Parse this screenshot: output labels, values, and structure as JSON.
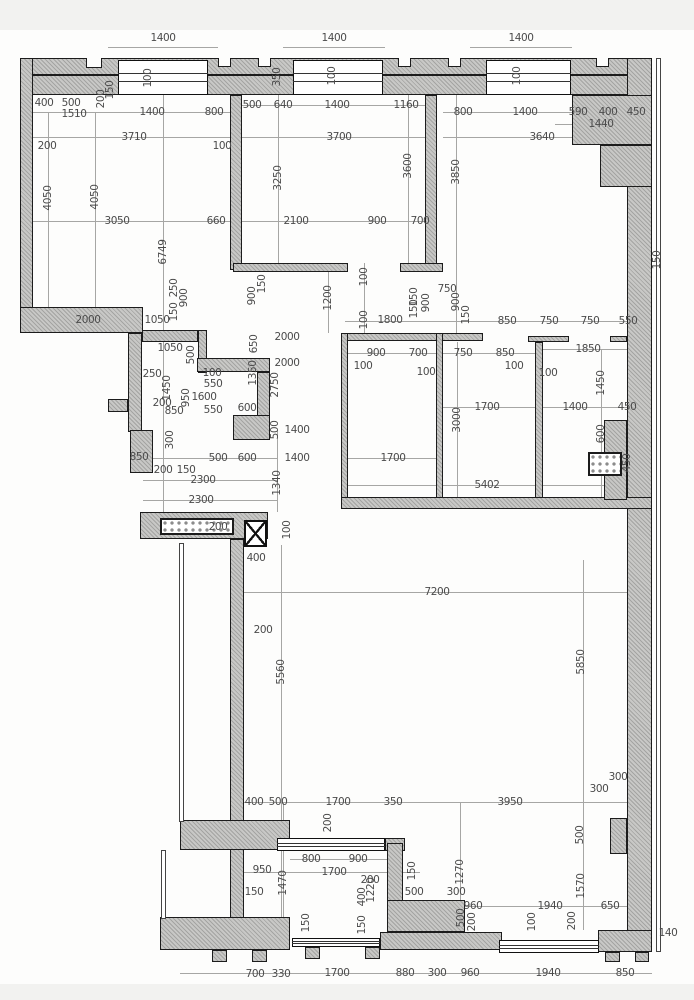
{
  "plan": {
    "size": {
      "w": 694,
      "h": 1000
    },
    "strips": [
      [
        0,
        0,
        694,
        30
      ],
      [
        0,
        984,
        694,
        16
      ]
    ],
    "walls": [
      [
        20,
        58,
        632,
        17
      ],
      [
        20,
        75,
        632,
        20
      ],
      [
        20,
        58,
        13,
        275
      ],
      [
        20,
        307,
        123,
        26
      ],
      [
        627,
        58,
        25,
        894
      ],
      [
        572,
        95,
        80,
        50
      ],
      [
        600,
        145,
        52,
        42
      ],
      [
        230,
        95,
        12,
        175
      ],
      [
        425,
        95,
        12,
        175
      ],
      [
        233,
        263,
        115,
        9
      ],
      [
        400,
        263,
        43,
        9
      ],
      [
        128,
        333,
        14,
        99
      ],
      [
        142,
        330,
        56,
        12
      ],
      [
        198,
        330,
        9,
        43
      ],
      [
        197,
        358,
        73,
        14
      ],
      [
        257,
        372,
        13,
        45
      ],
      [
        233,
        415,
        37,
        25
      ],
      [
        108,
        399,
        20,
        13
      ],
      [
        130,
        430,
        23,
        43
      ],
      [
        341,
        333,
        142,
        8
      ],
      [
        528,
        336,
        41,
        6
      ],
      [
        610,
        336,
        17,
        6
      ],
      [
        341,
        333,
        7,
        170
      ],
      [
        436,
        333,
        7,
        170
      ],
      [
        535,
        342,
        8,
        161
      ],
      [
        341,
        497,
        311,
        12
      ],
      [
        604,
        420,
        23,
        80
      ],
      [
        140,
        512,
        128,
        27
      ],
      [
        230,
        539,
        14,
        395
      ],
      [
        180,
        820,
        110,
        30
      ],
      [
        160,
        917,
        130,
        33
      ],
      [
        380,
        932,
        122,
        18
      ],
      [
        598,
        930,
        54,
        22
      ],
      [
        610,
        818,
        17,
        36
      ],
      [
        385,
        838,
        20,
        13
      ],
      [
        387,
        843,
        16,
        64
      ],
      [
        387,
        900,
        78,
        32
      ],
      [
        212,
        950,
        15,
        12
      ],
      [
        252,
        950,
        15,
        12
      ],
      [
        305,
        947,
        15,
        12
      ],
      [
        365,
        947,
        15,
        12
      ],
      [
        605,
        952,
        15,
        10
      ],
      [
        635,
        952,
        14,
        10
      ]
    ],
    "notches": [
      [
        86,
        58,
        16,
        10
      ],
      [
        218,
        58,
        13,
        9
      ],
      [
        258,
        58,
        13,
        9
      ],
      [
        398,
        58,
        13,
        9
      ],
      [
        448,
        58,
        13,
        9
      ],
      [
        596,
        58,
        13,
        9
      ]
    ],
    "thin": [
      [
        656,
        58,
        5,
        894
      ],
      [
        179,
        543,
        5,
        279
      ],
      [
        161,
        850,
        5,
        69
      ]
    ],
    "windows": [
      [
        118,
        60,
        90,
        35
      ],
      [
        293,
        60,
        90,
        35
      ],
      [
        486,
        60,
        85,
        35
      ],
      [
        499,
        940,
        100,
        13
      ],
      [
        277,
        838,
        108,
        13
      ],
      [
        292,
        938,
        88,
        9
      ]
    ],
    "vents": [
      [
        160,
        518,
        74,
        17
      ],
      [
        588,
        452,
        34,
        24
      ]
    ],
    "columns": [
      [
        244,
        520,
        23,
        27
      ]
    ],
    "lines": [
      [
        108,
        47,
        218,
        47
      ],
      [
        283,
        47,
        385,
        47
      ],
      [
        470,
        47,
        572,
        47
      ],
      [
        33,
        112,
        230,
        112
      ],
      [
        242,
        105,
        425,
        105
      ],
      [
        443,
        112,
        648,
        112
      ],
      [
        555,
        124,
        648,
        124
      ],
      [
        33,
        137,
        230,
        137
      ],
      [
        242,
        137,
        437,
        137
      ],
      [
        443,
        137,
        627,
        137
      ],
      [
        33,
        221,
        242,
        221
      ],
      [
        242,
        221,
        437,
        221
      ],
      [
        20,
        321,
        143,
        321
      ],
      [
        345,
        321,
        648,
        321
      ],
      [
        348,
        353,
        535,
        353
      ],
      [
        543,
        349,
        627,
        349
      ],
      [
        443,
        407,
        535,
        407
      ],
      [
        543,
        407,
        648,
        407
      ],
      [
        348,
        458,
        443,
        458
      ],
      [
        143,
        458,
        277,
        458
      ],
      [
        348,
        485,
        627,
        485
      ],
      [
        143,
        480,
        277,
        480
      ],
      [
        143,
        500,
        277,
        500
      ],
      [
        243,
        592,
        648,
        592
      ],
      [
        243,
        802,
        627,
        802
      ],
      [
        290,
        859,
        387,
        859
      ],
      [
        243,
        872,
        420,
        872
      ],
      [
        443,
        906,
        648,
        906
      ],
      [
        180,
        973,
        652,
        973
      ],
      [
        48,
        112,
        48,
        307
      ],
      [
        95,
        112,
        95,
        307
      ],
      [
        163,
        95,
        163,
        512
      ],
      [
        278,
        95,
        278,
        263
      ],
      [
        408,
        95,
        408,
        263
      ],
      [
        456,
        95,
        456,
        335
      ],
      [
        281,
        545,
        281,
        932
      ],
      [
        583,
        560,
        583,
        930
      ],
      [
        601,
        349,
        601,
        497
      ],
      [
        457,
        342,
        457,
        497
      ],
      [
        328,
        270,
        328,
        333
      ],
      [
        277,
        430,
        277,
        512
      ],
      [
        460,
        802,
        460,
        932
      ],
      [
        283,
        802,
        283,
        932
      ],
      [
        364,
        263,
        364,
        333
      ]
    ],
    "labels": [
      {
        "t": "1400",
        "x": 163,
        "y": 38
      },
      {
        "t": "1400",
        "x": 334,
        "y": 38
      },
      {
        "t": "1400",
        "x": 521,
        "y": 38
      },
      {
        "t": "200",
        "x": 101,
        "y": 99,
        "r": 1
      },
      {
        "t": "150",
        "x": 110,
        "y": 90,
        "r": 1
      },
      {
        "t": "100",
        "x": 148,
        "y": 78,
        "r": 1
      },
      {
        "t": "350",
        "x": 277,
        "y": 77,
        "r": 1
      },
      {
        "t": "100",
        "x": 332,
        "y": 76,
        "r": 1
      },
      {
        "t": "100",
        "x": 517,
        "y": 76,
        "r": 1
      },
      {
        "t": "400",
        "x": 44,
        "y": 103
      },
      {
        "t": "500",
        "x": 71,
        "y": 103
      },
      {
        "t": "1510",
        "x": 74,
        "y": 114
      },
      {
        "t": "1400",
        "x": 152,
        "y": 112
      },
      {
        "t": "800",
        "x": 214,
        "y": 112
      },
      {
        "t": "500",
        "x": 252,
        "y": 105
      },
      {
        "t": "640",
        "x": 283,
        "y": 105
      },
      {
        "t": "1400",
        "x": 337,
        "y": 105
      },
      {
        "t": "1160",
        "x": 406,
        "y": 105
      },
      {
        "t": "800",
        "x": 463,
        "y": 112
      },
      {
        "t": "1400",
        "x": 525,
        "y": 112
      },
      {
        "t": "590",
        "x": 578,
        "y": 112
      },
      {
        "t": "400",
        "x": 608,
        "y": 112
      },
      {
        "t": "450",
        "x": 636,
        "y": 112
      },
      {
        "t": "1440",
        "x": 601,
        "y": 124
      },
      {
        "t": "3710",
        "x": 134,
        "y": 137
      },
      {
        "t": "200",
        "x": 47,
        "y": 146
      },
      {
        "t": "100",
        "x": 222,
        "y": 146
      },
      {
        "t": "3700",
        "x": 339,
        "y": 137
      },
      {
        "t": "3640",
        "x": 542,
        "y": 137
      },
      {
        "t": "4050",
        "x": 48,
        "y": 198,
        "r": 1
      },
      {
        "t": "4050",
        "x": 95,
        "y": 197,
        "r": 1
      },
      {
        "t": "3250",
        "x": 278,
        "y": 178,
        "r": 1
      },
      {
        "t": "3600",
        "x": 408,
        "y": 166,
        "r": 1
      },
      {
        "t": "3850",
        "x": 456,
        "y": 172,
        "r": 1
      },
      {
        "t": "150",
        "x": 657,
        "y": 260,
        "r": 1
      },
      {
        "t": "3050",
        "x": 117,
        "y": 221
      },
      {
        "t": "660",
        "x": 216,
        "y": 221
      },
      {
        "t": "2100",
        "x": 296,
        "y": 221
      },
      {
        "t": "900",
        "x": 377,
        "y": 221
      },
      {
        "t": "700",
        "x": 420,
        "y": 221
      },
      {
        "t": "6749",
        "x": 163,
        "y": 252,
        "r": 1
      },
      {
        "t": "250",
        "x": 174,
        "y": 288,
        "r": 1
      },
      {
        "t": "900",
        "x": 184,
        "y": 298,
        "r": 1
      },
      {
        "t": "150",
        "x": 174,
        "y": 312,
        "r": 1
      },
      {
        "t": "2000",
        "x": 88,
        "y": 320
      },
      {
        "t": "1050",
        "x": 157,
        "y": 320
      },
      {
        "t": "150",
        "x": 262,
        "y": 284,
        "r": 1
      },
      {
        "t": "900",
        "x": 252,
        "y": 296,
        "r": 1
      },
      {
        "t": "1200",
        "x": 328,
        "y": 298,
        "r": 1
      },
      {
        "t": "100",
        "x": 364,
        "y": 277,
        "r": 1
      },
      {
        "t": "100",
        "x": 364,
        "y": 320,
        "r": 1
      },
      {
        "t": "1800",
        "x": 390,
        "y": 320
      },
      {
        "t": "150",
        "x": 414,
        "y": 297,
        "r": 1
      },
      {
        "t": "150",
        "x": 414,
        "y": 309,
        "r": 1
      },
      {
        "t": "900",
        "x": 426,
        "y": 303,
        "r": 1
      },
      {
        "t": "750",
        "x": 447,
        "y": 289
      },
      {
        "t": "900",
        "x": 456,
        "y": 302,
        "r": 1
      },
      {
        "t": "150",
        "x": 466,
        "y": 315,
        "r": 1
      },
      {
        "t": "850",
        "x": 507,
        "y": 321
      },
      {
        "t": "750",
        "x": 549,
        "y": 321
      },
      {
        "t": "750",
        "x": 590,
        "y": 321
      },
      {
        "t": "550",
        "x": 628,
        "y": 321
      },
      {
        "t": "2000",
        "x": 287,
        "y": 337
      },
      {
        "t": "2000",
        "x": 287,
        "y": 363
      },
      {
        "t": "650",
        "x": 254,
        "y": 344,
        "r": 1
      },
      {
        "t": "1050",
        "x": 170,
        "y": 348
      },
      {
        "t": "500",
        "x": 191,
        "y": 355,
        "r": 1
      },
      {
        "t": "1350",
        "x": 253,
        "y": 373,
        "r": 1
      },
      {
        "t": "2750",
        "x": 275,
        "y": 385,
        "r": 1
      },
      {
        "t": "250",
        "x": 152,
        "y": 374
      },
      {
        "t": "1450",
        "x": 167,
        "y": 388,
        "r": 1
      },
      {
        "t": "100",
        "x": 212,
        "y": 373
      },
      {
        "t": "550",
        "x": 213,
        "y": 384
      },
      {
        "t": "950",
        "x": 186,
        "y": 398,
        "r": 1
      },
      {
        "t": "1600",
        "x": 204,
        "y": 397
      },
      {
        "t": "200",
        "x": 162,
        "y": 403
      },
      {
        "t": "850",
        "x": 174,
        "y": 411
      },
      {
        "t": "550",
        "x": 213,
        "y": 410
      },
      {
        "t": "600",
        "x": 247,
        "y": 408
      },
      {
        "t": "500",
        "x": 275,
        "y": 430,
        "r": 1
      },
      {
        "t": "1400",
        "x": 297,
        "y": 430
      },
      {
        "t": "1400",
        "x": 297,
        "y": 458
      },
      {
        "t": "300",
        "x": 170,
        "y": 440,
        "r": 1
      },
      {
        "t": "850",
        "x": 139,
        "y": 457
      },
      {
        "t": "500",
        "x": 218,
        "y": 458
      },
      {
        "t": "600",
        "x": 247,
        "y": 458
      },
      {
        "t": "200",
        "x": 163,
        "y": 470
      },
      {
        "t": "150",
        "x": 186,
        "y": 470
      },
      {
        "t": "2300",
        "x": 203,
        "y": 480
      },
      {
        "t": "2300",
        "x": 201,
        "y": 500
      },
      {
        "t": "1340",
        "x": 277,
        "y": 483,
        "r": 1
      },
      {
        "t": "900",
        "x": 376,
        "y": 353
      },
      {
        "t": "700",
        "x": 418,
        "y": 353
      },
      {
        "t": "750",
        "x": 463,
        "y": 353
      },
      {
        "t": "850",
        "x": 505,
        "y": 353
      },
      {
        "t": "100",
        "x": 363,
        "y": 366
      },
      {
        "t": "100",
        "x": 426,
        "y": 372
      },
      {
        "t": "100",
        "x": 514,
        "y": 366
      },
      {
        "t": "1850",
        "x": 588,
        "y": 349
      },
      {
        "t": "100",
        "x": 548,
        "y": 373
      },
      {
        "t": "1450",
        "x": 601,
        "y": 383,
        "r": 1
      },
      {
        "t": "1700",
        "x": 487,
        "y": 407
      },
      {
        "t": "3000",
        "x": 457,
        "y": 420,
        "r": 1
      },
      {
        "t": "1400",
        "x": 575,
        "y": 407
      },
      {
        "t": "450",
        "x": 627,
        "y": 407
      },
      {
        "t": "600",
        "x": 601,
        "y": 434,
        "r": 1
      },
      {
        "t": "450",
        "x": 627,
        "y": 463,
        "r": 1
      },
      {
        "t": "1700",
        "x": 393,
        "y": 458
      },
      {
        "t": "5402",
        "x": 487,
        "y": 485
      },
      {
        "t": "200",
        "x": 218,
        "y": 527
      },
      {
        "t": "100",
        "x": 287,
        "y": 530,
        "r": 1
      },
      {
        "t": "400",
        "x": 256,
        "y": 558
      },
      {
        "t": "7200",
        "x": 437,
        "y": 592
      },
      {
        "t": "200",
        "x": 263,
        "y": 630
      },
      {
        "t": "5560",
        "x": 281,
        "y": 672,
        "r": 1
      },
      {
        "t": "5850",
        "x": 581,
        "y": 662,
        "r": 1
      },
      {
        "t": "300",
        "x": 618,
        "y": 777
      },
      {
        "t": "300",
        "x": 599,
        "y": 789
      },
      {
        "t": "400",
        "x": 254,
        "y": 802
      },
      {
        "t": "500",
        "x": 278,
        "y": 802
      },
      {
        "t": "1700",
        "x": 338,
        "y": 802
      },
      {
        "t": "350",
        "x": 393,
        "y": 802
      },
      {
        "t": "3950",
        "x": 510,
        "y": 802
      },
      {
        "t": "200",
        "x": 328,
        "y": 823,
        "r": 1
      },
      {
        "t": "800",
        "x": 311,
        "y": 859
      },
      {
        "t": "900",
        "x": 358,
        "y": 859
      },
      {
        "t": "1700",
        "x": 334,
        "y": 872
      },
      {
        "t": "200",
        "x": 370,
        "y": 880
      },
      {
        "t": "150",
        "x": 412,
        "y": 871,
        "r": 1
      },
      {
        "t": "950",
        "x": 262,
        "y": 870
      },
      {
        "t": "150",
        "x": 254,
        "y": 892
      },
      {
        "t": "1470",
        "x": 283,
        "y": 883,
        "r": 1
      },
      {
        "t": "500",
        "x": 414,
        "y": 892
      },
      {
        "t": "300",
        "x": 456,
        "y": 892
      },
      {
        "t": "1270",
        "x": 460,
        "y": 872,
        "r": 1
      },
      {
        "t": "500",
        "x": 580,
        "y": 835,
        "r": 1
      },
      {
        "t": "1570",
        "x": 581,
        "y": 886,
        "r": 1
      },
      {
        "t": "960",
        "x": 473,
        "y": 906
      },
      {
        "t": "1940",
        "x": 550,
        "y": 906
      },
      {
        "t": "650",
        "x": 610,
        "y": 906
      },
      {
        "t": "500",
        "x": 461,
        "y": 918,
        "r": 1
      },
      {
        "t": "200",
        "x": 472,
        "y": 922,
        "r": 1
      },
      {
        "t": "100",
        "x": 532,
        "y": 922,
        "r": 1
      },
      {
        "t": "200",
        "x": 572,
        "y": 921,
        "r": 1
      },
      {
        "t": "150",
        "x": 306,
        "y": 923,
        "r": 1
      },
      {
        "t": "150",
        "x": 362,
        "y": 925,
        "r": 1
      },
      {
        "t": "400",
        "x": 362,
        "y": 897,
        "r": 1
      },
      {
        "t": "1220",
        "x": 371,
        "y": 890,
        "r": 1
      },
      {
        "t": "140",
        "x": 668,
        "y": 933
      },
      {
        "t": "700",
        "x": 255,
        "y": 974
      },
      {
        "t": "330",
        "x": 281,
        "y": 974
      },
      {
        "t": "1700",
        "x": 337,
        "y": 973
      },
      {
        "t": "880",
        "x": 405,
        "y": 973
      },
      {
        "t": "300",
        "x": 437,
        "y": 973
      },
      {
        "t": "960",
        "x": 470,
        "y": 973
      },
      {
        "t": "1940",
        "x": 548,
        "y": 973
      },
      {
        "t": "850",
        "x": 625,
        "y": 973
      }
    ]
  }
}
